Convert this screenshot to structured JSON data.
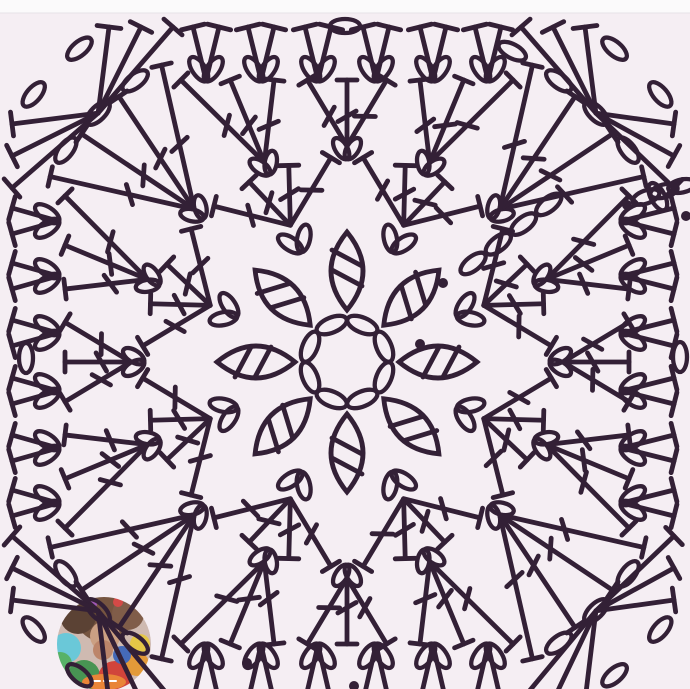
{
  "app": {
    "kind": "crochet-chart-photo",
    "background": "#f5eef3",
    "top_strip_color": "#fbfafb",
    "top_strip_edge": "#e6e1e7",
    "line_color": "#332036"
  },
  "diagram": {
    "canvas": {
      "w": 690,
      "h": 689
    },
    "stroke": {
      "width": 4.8,
      "oval_width": 4.3
    },
    "center": [
      347,
      362
    ],
    "ring": {
      "count": 8,
      "radius": 40,
      "oval_rx": 16,
      "oval_ry": 7.5
    },
    "petals": {
      "count": 8,
      "start_angle": 90,
      "step": 45,
      "r_inner": 52,
      "r_outer": 130,
      "bulge": 32,
      "tick_radii": [
        84,
        104
      ],
      "tick_half": 17
    },
    "row_a": {
      "count": 8,
      "angle_offset": 22.5,
      "step": 45,
      "radius": 120,
      "ear_angle": 34,
      "ear_dist": 13,
      "ear_rx": 14,
      "ear_ry": 6.5
    },
    "round2": {
      "fan_count": 8,
      "angle_offset": 22.5,
      "step": 45,
      "base_r": 148,
      "top_r": 205,
      "spokes": 4,
      "spread": 36,
      "bar_half": 10,
      "slash_at": 0.52,
      "slash_len": 21
    },
    "row_b": {
      "count": 16,
      "step": 22.5,
      "radius": 204,
      "ear_angle": 32,
      "ear_dist": 11,
      "ear_rx": 12,
      "ear_ry": 6
    },
    "round3": {
      "fan_count": 16,
      "step": 22.5,
      "base_r": 216,
      "top_square": 282,
      "spokes": 3,
      "spread": 16,
      "corner_spokes": 4,
      "corner_spread": 26,
      "corner_top_r": 350,
      "bar_half": 10,
      "slash_at": 0.45,
      "slash_len": 21
    },
    "border": {
      "pair_offsets": [
        -141,
        -86,
        -29,
        29,
        86,
        141
      ],
      "pair_top_spread": 13,
      "bar_half": 12,
      "sides": [
        {
          "name": "top",
          "base": 80,
          "bar": 27
        },
        {
          "name": "bottom",
          "base": 645,
          "bar": 701
        },
        {
          "name": "left",
          "base": 58,
          "bar": 12
        },
        {
          "name": "right",
          "base": 622,
          "bar": 674
        }
      ],
      "corner_fan_offsets": [
        174,
        206,
        238
      ],
      "corner_diagonals": [
        45,
        135,
        225,
        315
      ],
      "corner_arc": {
        "radius": 352,
        "angles": [
          -8,
          0,
          8
        ],
        "oval_rx": 15,
        "oval_ry": 7
      },
      "corner_tips": {
        "radius": 412,
        "angles": [
          -4.5,
          4.5
        ],
        "oval_rx": 15,
        "oval_ry": 7
      },
      "mid_ovals": [
        {
          "at": [
            345,
            26
          ],
          "rot": 0
        },
        {
          "at": [
            26,
            358
          ],
          "rot": 90
        },
        {
          "at": [
            680,
            357
          ],
          "rot": 90
        }
      ]
    },
    "extras": {
      "ne_chain": {
        "angle": 38,
        "radii": [
          160,
          192,
          224,
          256
        ],
        "oval_rx": 15,
        "oval_ry": 7
      },
      "ne_corner_extra_arc_angles": [
        -17,
        17
      ],
      "edge_chain": [
        [
          646,
          197,
          -20
        ],
        [
          664,
          191,
          -15
        ],
        [
          682,
          186,
          -12
        ]
      ],
      "dots": [
        [
          420,
          344
        ],
        [
          443,
          283
        ],
        [
          627,
          205
        ],
        [
          686,
          216
        ],
        [
          247,
          663
        ],
        [
          354,
          686
        ]
      ],
      "dot_r": 5
    },
    "watermark": {
      "cx": 104,
      "cy": 644,
      "r": 47,
      "base": "#cdb7ad",
      "opacity": 0.95,
      "blobs": [
        [
          104,
          612,
          30,
          "#6f4c36"
        ],
        [
          78,
          616,
          18,
          "#53382a"
        ],
        [
          128,
          614,
          16,
          "#7a5540"
        ],
        [
          105,
          636,
          15,
          "#c99b7d"
        ],
        [
          103,
          650,
          10,
          "#b97f63"
        ],
        [
          66,
          648,
          15,
          "#62c6d6"
        ],
        [
          60,
          664,
          12,
          "#4fae5f"
        ],
        [
          84,
          676,
          16,
          "#3f8f4a"
        ],
        [
          115,
          678,
          17,
          "#cf3a31"
        ],
        [
          137,
          664,
          12,
          "#e2952f"
        ],
        [
          140,
          644,
          10,
          "#e3c43e"
        ],
        [
          122,
          655,
          9,
          "#3b63b5"
        ],
        [
          92,
          604,
          5,
          "#9a4fb0"
        ],
        [
          118,
          602,
          5,
          "#d2413e"
        ]
      ],
      "banner": {
        "cx": 104,
        "cy": 682,
        "rx": 22,
        "ry": 8,
        "color": "#e87f2e"
      }
    },
    "top_strip_height": 13
  }
}
